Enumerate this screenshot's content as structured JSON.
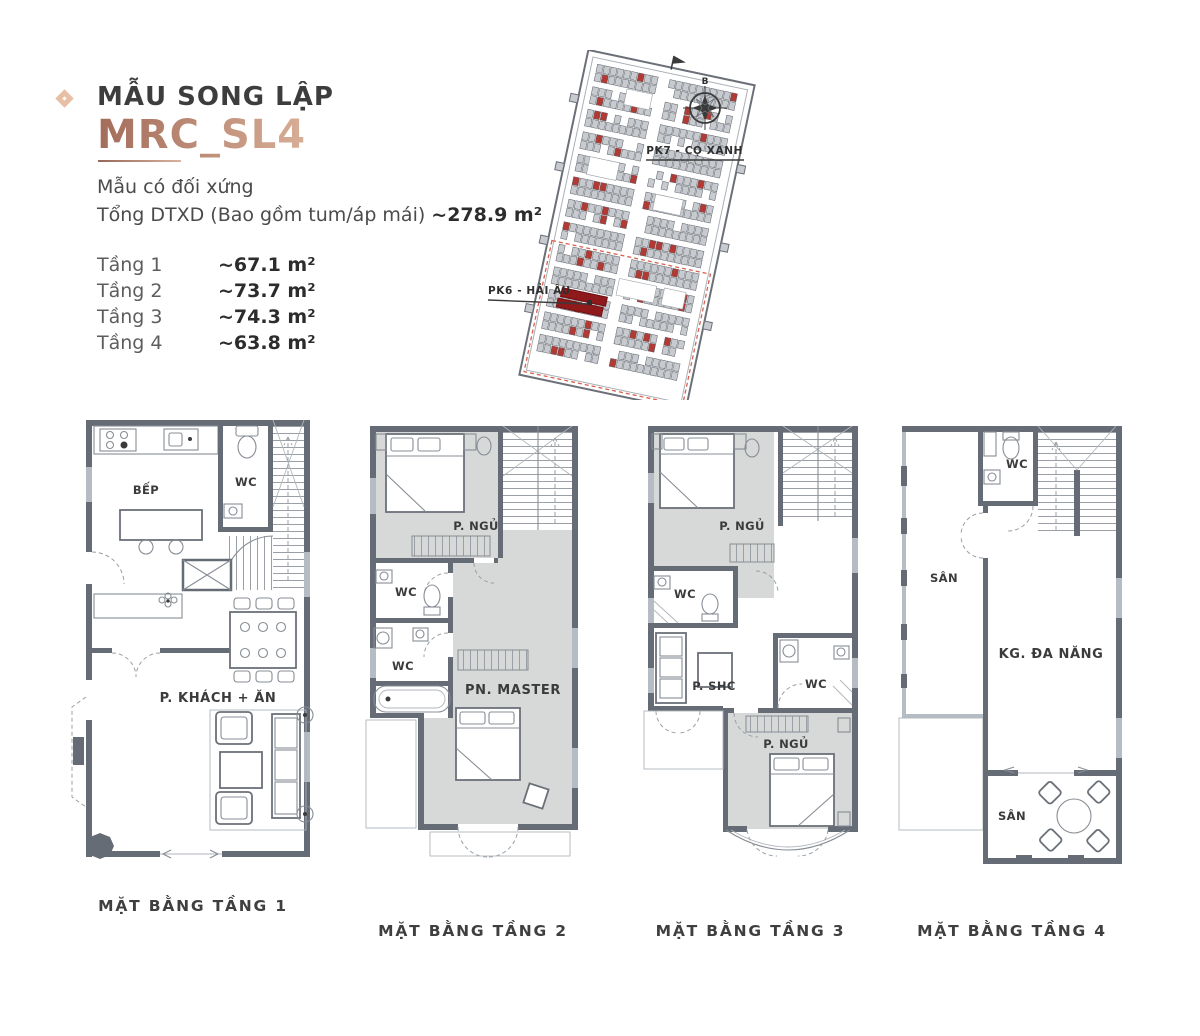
{
  "header": {
    "title": "MẪU SONG LẬP",
    "model": "MRC_SL4",
    "note": "Mẫu có đối xứng",
    "total_label": "Tổng DTXD (Bao gồm tum/áp mái)",
    "total_value": "~278.9 m²",
    "floors": [
      {
        "label": "Tầng 1",
        "area": "~67.1 m²"
      },
      {
        "label": "Tầng 2",
        "area": "~73.7 m²"
      },
      {
        "label": "Tầng 3",
        "area": "~74.3 m²"
      },
      {
        "label": "Tầng 4",
        "area": "~63.8 m²"
      }
    ]
  },
  "siteplan": {
    "north_label": "B",
    "zone_labels": [
      {
        "text": "PK7 - CỌ XANH"
      },
      {
        "text": "PK6 - HẢI ÂU"
      }
    ]
  },
  "plans": [
    {
      "caption": "MẶT BẰNG TẦNG 1",
      "rooms": {
        "kitchen": "BẾP",
        "wc": "WC",
        "living": "P. KHÁCH + ĂN"
      }
    },
    {
      "caption": "MẶT BẰNG TẦNG 2",
      "rooms": {
        "bedroom": "P. NGỦ",
        "wc1": "WC",
        "wc2": "WC",
        "master": "PN. MASTER"
      }
    },
    {
      "caption": "MẶT BẰNG TẦNG 3",
      "rooms": {
        "bedroom": "P. NGỦ",
        "wc1": "WC",
        "family": "P. SHC",
        "wc2": "WC",
        "bedroom2": "P. NGỦ"
      }
    },
    {
      "caption": "MẶT BẰNG TẦNG 4",
      "rooms": {
        "wc": "WC",
        "terrace1": "SÂN",
        "multi": "KG. ĐA NĂNG",
        "terrace2": "SÂN"
      }
    }
  ],
  "colors": {
    "accent": "#e7bfa5",
    "model_text": "#b5826e",
    "ink": "#3b3b3b",
    "wall_gray": "#666c76",
    "room_shade": "#d7d9d8",
    "lot_red": "#b23a34",
    "subject_lot_red": "#8e1a1c"
  }
}
